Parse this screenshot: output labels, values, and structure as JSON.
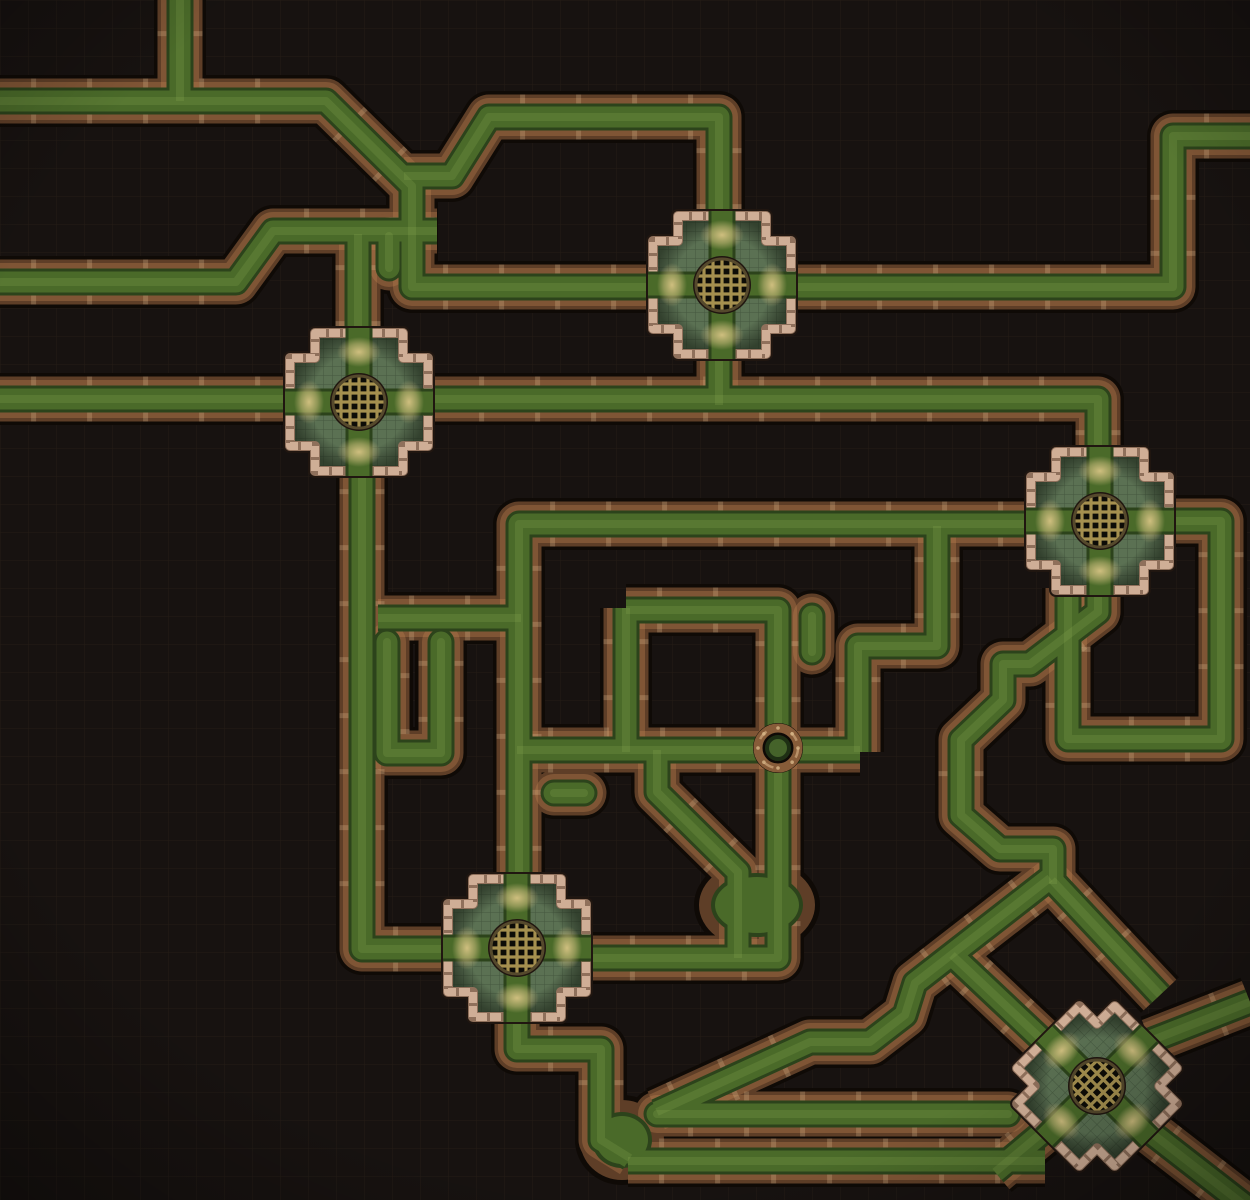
{
  "map": {
    "kind": "sewer-pipes-battlemap",
    "canvas": {
      "width": 1250,
      "height": 1200
    },
    "grid": {
      "cell": 28,
      "line_color": "rgba(110,90,60,0.14)"
    },
    "colors": {
      "bg": "#171210",
      "pipe_outer": "#0f0a06",
      "pipe_wall": "#5e3e27",
      "pipe_wall_hi": "rgba(190,130,80,0.35)",
      "coupling": "rgba(226,196,152,0.25)",
      "sludge_edge": "#2c431b",
      "sludge": "#4a6a29",
      "sludge_hi": "rgba(140,175,80,0.40)",
      "platform_outer": "#201610",
      "mortar": "#8f705b",
      "brick": "#cfae96",
      "stone": "#5b7153",
      "stone_line": "rgba(10,20,10,0.28)",
      "fan": "#d6c383",
      "grate_bg": "#0d0c07",
      "grate_bar": "#a5904f",
      "grate_ring": "#55492c",
      "valve_ring": "#875c39",
      "valve_glint": "#d9b287",
      "valve_bolt": "#d8b88a",
      "valve_center": "#45632a",
      "valve_center_rim": "#1e2f14"
    },
    "pipe_style": {
      "outer_w": 52,
      "wall_w": 45,
      "wall_hi_w": 38,
      "edge_w": 27,
      "sludge_w": 21,
      "streak_w": 8,
      "tick_step": 56,
      "tick_len": 5
    },
    "pipes": [
      {
        "name": "top-feed",
        "pts": [
          [
            180,
            0
          ],
          [
            180,
            101
          ]
        ]
      },
      {
        "name": "west-main",
        "pts": [
          [
            0,
            101
          ],
          [
            326,
            101
          ],
          [
            412,
            186
          ],
          [
            412,
            287
          ],
          [
            658,
            287
          ]
        ]
      },
      {
        "name": "upper-run",
        "pts": [
          [
            404,
            176
          ],
          [
            452,
            176
          ],
          [
            489,
            117
          ],
          [
            719,
            117
          ],
          [
            719,
            240
          ]
        ]
      },
      {
        "name": "west-second",
        "pts": [
          [
            0,
            282
          ],
          [
            236,
            282
          ],
          [
            273,
            231
          ],
          [
            437,
            231
          ]
        ]
      },
      {
        "name": "j2-top-feed",
        "pts": [
          [
            358,
            234
          ],
          [
            358,
            360
          ]
        ]
      },
      {
        "name": "mid-main",
        "pts": [
          [
            0,
            399
          ],
          [
            1098,
            399
          ],
          [
            1098,
            545
          ]
        ]
      },
      {
        "name": "j1-drop",
        "pts": [
          [
            719,
            338
          ],
          [
            719,
            405
          ]
        ]
      },
      {
        "name": "east-upper",
        "pts": [
          [
            790,
            287
          ],
          [
            1173,
            287
          ],
          [
            1173,
            136
          ],
          [
            1250,
            136
          ]
        ]
      },
      {
        "name": "j2-drop",
        "pts": [
          [
            362,
            458
          ],
          [
            362,
            949
          ],
          [
            462,
            949
          ]
        ]
      },
      {
        "name": "branch",
        "pts": [
          [
            378,
            618
          ],
          [
            521,
            618
          ]
        ]
      },
      {
        "name": "center-loop",
        "pts": [
          [
            519,
            882
          ],
          [
            519,
            524
          ],
          [
            1036,
            524
          ]
        ]
      },
      {
        "name": "z-link",
        "pts": [
          [
            937,
            526
          ],
          [
            937,
            646
          ],
          [
            858,
            646
          ],
          [
            858,
            752
          ]
        ]
      },
      {
        "name": "valve-run",
        "pts": [
          [
            517,
            750
          ],
          [
            860,
            750
          ]
        ]
      },
      {
        "name": "east-center-loop",
        "pts": [
          [
            626,
            610
          ],
          [
            778,
            610
          ],
          [
            778,
            958
          ],
          [
            586,
            958
          ]
        ]
      },
      {
        "name": "v-link",
        "pts": [
          [
            626,
            608
          ],
          [
            626,
            752
          ]
        ]
      },
      {
        "name": "diag-drop",
        "pts": [
          [
            657,
            750
          ],
          [
            657,
            792
          ],
          [
            738,
            872
          ],
          [
            738,
            958
          ]
        ]
      },
      {
        "name": "u-trap",
        "pts": [
          [
            387,
            642
          ],
          [
            387,
            753
          ],
          [
            441,
            753
          ],
          [
            441,
            642
          ]
        ],
        "cap": "round"
      },
      {
        "name": "j3-descent",
        "pts": [
          [
            1098,
            545
          ],
          [
            1098,
            612
          ],
          [
            1030,
            664
          ],
          [
            1003,
            664
          ],
          [
            1003,
            700
          ],
          [
            961,
            740
          ],
          [
            961,
            815
          ],
          [
            1000,
            849
          ],
          [
            1053,
            849
          ],
          [
            1053,
            884
          ]
        ]
      },
      {
        "name": "j3-loop",
        "pts": [
          [
            1160,
            521
          ],
          [
            1221,
            521
          ],
          [
            1221,
            739
          ],
          [
            1068,
            739
          ],
          [
            1068,
            588
          ]
        ]
      },
      {
        "name": "west-leg",
        "pts": [
          [
            1050,
            878
          ],
          [
            915,
            983
          ],
          [
            905,
            1015
          ],
          [
            870,
            1042
          ],
          [
            810,
            1042
          ],
          [
            657,
            1112
          ]
        ]
      },
      {
        "name": "east-leg",
        "pts": [
          [
            1052,
            880
          ],
          [
            1160,
            995
          ]
        ]
      },
      {
        "name": "j5-nw-arm",
        "pts": [
          [
            952,
            955
          ],
          [
            1055,
            1052
          ]
        ]
      },
      {
        "name": "j4-bottom",
        "pts": [
          [
            517,
            1012
          ],
          [
            517,
            1049
          ],
          [
            601,
            1049
          ],
          [
            601,
            1140
          ],
          [
            630,
            1158
          ]
        ]
      },
      {
        "name": "bottom-run",
        "pts": [
          [
            628,
            1161
          ],
          [
            1045,
            1161
          ]
        ]
      },
      {
        "name": "bottom-upper-run",
        "pts": [
          [
            657,
            1114
          ],
          [
            1008,
            1114
          ]
        ],
        "cap": "round"
      },
      {
        "name": "j5-sw-arm",
        "pts": [
          [
            995,
            1172
          ],
          [
            1075,
            1105
          ]
        ]
      },
      {
        "name": "j5-ne-arm",
        "pts": [
          [
            1250,
            1002
          ],
          [
            1150,
            1041
          ]
        ]
      },
      {
        "name": "j5-se-arm",
        "pts": [
          [
            1140,
            1124
          ],
          [
            1248,
            1208
          ]
        ]
      },
      {
        "name": "stub-a",
        "pts": [
          [
            812,
            616
          ],
          [
            812,
            652
          ]
        ],
        "cap": "round"
      },
      {
        "name": "stub-b",
        "pts": [
          [
            584,
            793
          ],
          [
            554,
            793
          ]
        ],
        "cap": "round"
      },
      {
        "name": "stub-c",
        "pts": [
          [
            389,
            236
          ],
          [
            389,
            268
          ]
        ],
        "cap": "round"
      }
    ],
    "pools": [
      {
        "name": "confluence-pool",
        "cx": 757,
        "cy": 905,
        "rx": 58,
        "ry": 44
      },
      {
        "name": "bottom-junction-pool",
        "cx": 622,
        "cy": 1140,
        "rx": 42,
        "ry": 40
      }
    ],
    "platform_style": {
      "half": 69,
      "arm_half": 44,
      "shade": "rgba(18,26,16,0.55)",
      "strip_len": 74,
      "fan_dist": 50,
      "fan_rx": 22,
      "fan_ry": 15,
      "grate_r": 26
    },
    "junctions": [
      {
        "name": "junction-north",
        "cx": 722,
        "cy": 285,
        "rot": 0
      },
      {
        "name": "junction-west",
        "cx": 359,
        "cy": 402,
        "rot": 0
      },
      {
        "name": "junction-east",
        "cx": 1100,
        "cy": 521,
        "rot": 0
      },
      {
        "name": "junction-south",
        "cx": 517,
        "cy": 948,
        "rot": 0
      },
      {
        "name": "junction-southeast",
        "cx": 1097,
        "cy": 1086,
        "rot": 45
      }
    ],
    "valve": {
      "cx": 778,
      "cy": 748,
      "r": 20
    }
  }
}
